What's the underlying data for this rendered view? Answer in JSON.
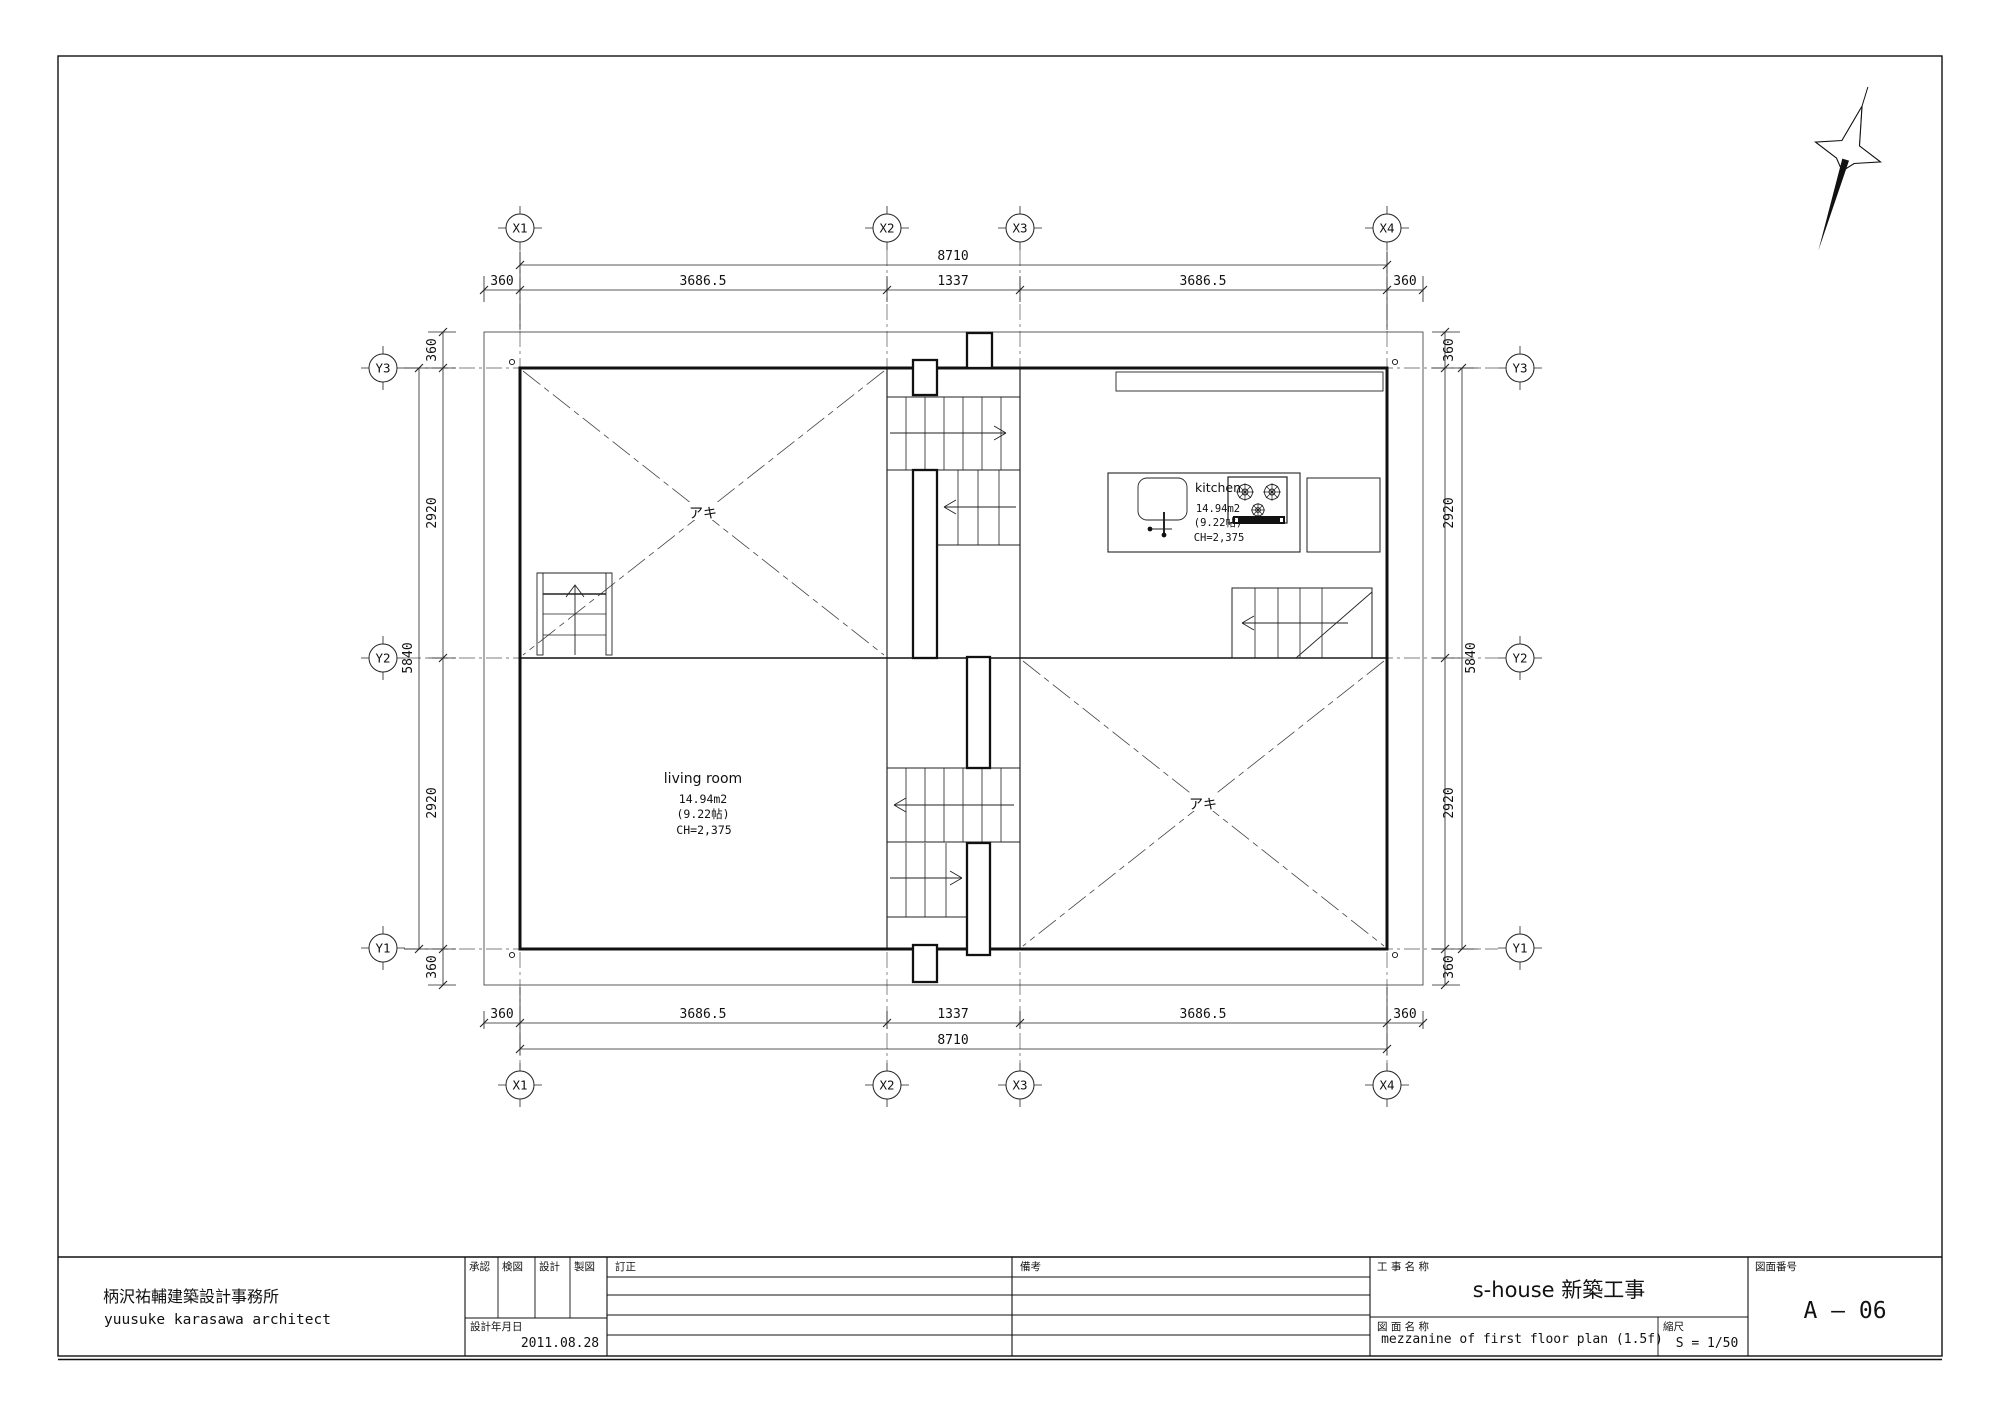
{
  "title_block": {
    "architect_jp": "柄沢祐輔建築設計事務所",
    "architect_en": "yuusuke karasawa architect",
    "approval_label": "承認",
    "check_label": "検図",
    "design_label": "設計",
    "drafting_label": "製図",
    "revision_label": "訂正",
    "remarks_label": "備考",
    "design_date_label": "設計年月日",
    "design_date": "2011.08.28",
    "project_label": "工 事 名 称",
    "project_name": "s-house 新築工事",
    "drawing_label": "図 面 名 称",
    "drawing_name": "mezzanine of first floor plan (1.5f)",
    "scale_label": "縮尺",
    "scale_value": "S = 1/50",
    "number_label": "図面番号",
    "drawing_number": "A — 06"
  },
  "grid": {
    "x_labels": [
      "X1",
      "X2",
      "X3",
      "X4"
    ],
    "y_labels": [
      "Y3",
      "Y2",
      "Y1"
    ]
  },
  "dimensions": {
    "total_width": "8710",
    "total_height": "5840",
    "top_segments": [
      "360",
      "3686.5",
      "1337",
      "3686.5",
      "360"
    ],
    "bottom_segments": [
      "360",
      "3686.5",
      "1337",
      "3686.5",
      "360"
    ],
    "left_segments": [
      "360",
      "2920",
      "2920",
      "360"
    ],
    "right_segments": [
      "360",
      "2920",
      "2920",
      "360"
    ]
  },
  "rooms": {
    "living_room": {
      "name": "living room",
      "area": "14.94m2",
      "tatami": "(9.22帖)",
      "ceiling": "CH=2,375"
    },
    "kitchen": {
      "name": "kitchen",
      "area": "14.94m2",
      "tatami": "(9.22帖)",
      "ceiling": "CH=2,375"
    },
    "void_label_1": "アキ",
    "void_label_2": "アキ"
  }
}
